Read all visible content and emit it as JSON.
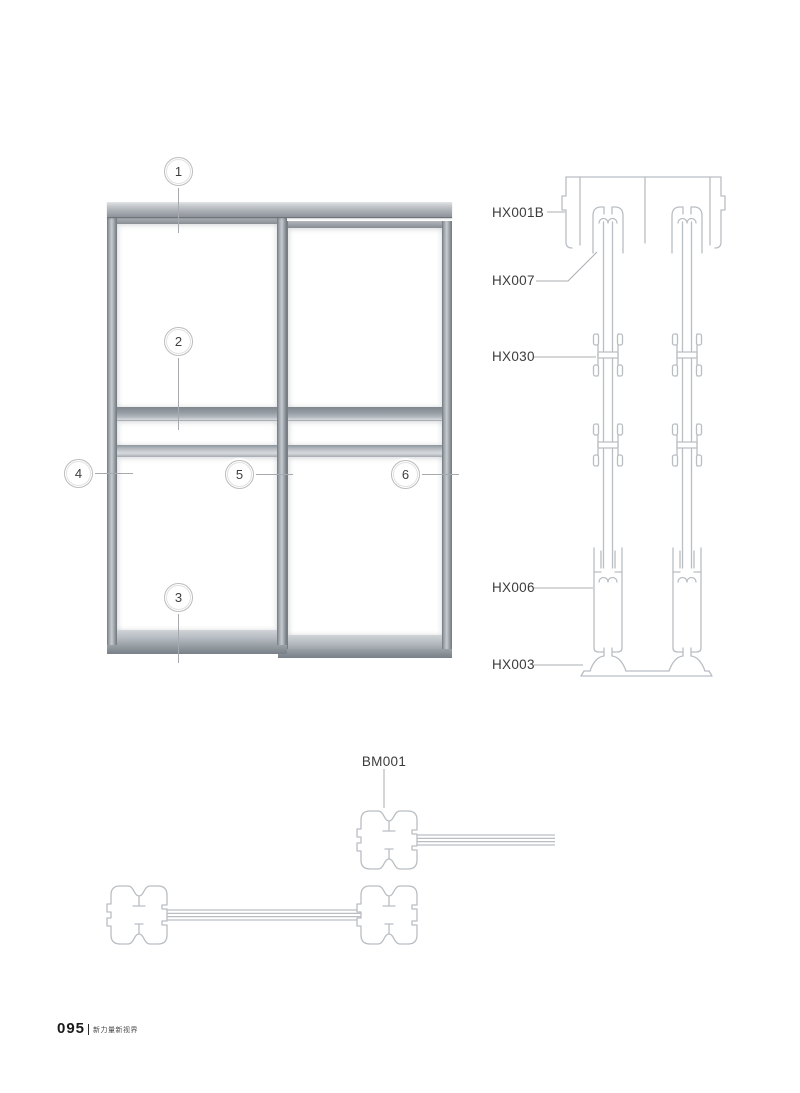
{
  "elevation": {
    "callouts": [
      {
        "number": "1"
      },
      {
        "number": "2"
      },
      {
        "number": "3"
      },
      {
        "number": "4"
      },
      {
        "number": "5"
      },
      {
        "number": "6"
      }
    ]
  },
  "section": {
    "labels": [
      {
        "code": "HX001B"
      },
      {
        "code": "HX007"
      },
      {
        "code": "HX030"
      },
      {
        "code": "HX006"
      },
      {
        "code": "HX003"
      }
    ]
  },
  "plan": {
    "labels": [
      {
        "code": "BM001"
      }
    ]
  },
  "footer": {
    "page_number": "095",
    "tagline": "新力量新视界"
  }
}
